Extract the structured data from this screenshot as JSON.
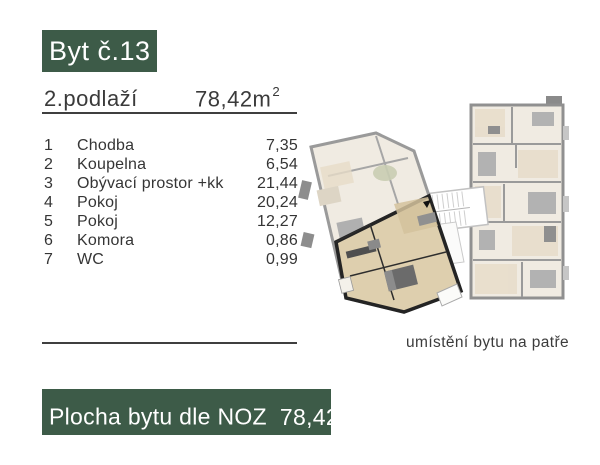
{
  "header": {
    "unit_title": "Byt č.13",
    "floor_label": "2.podlaží",
    "area_value": "78,42m",
    "area_superscript": "2"
  },
  "rooms": {
    "items": [
      {
        "no": "1",
        "name": "Chodba",
        "area": "7,35"
      },
      {
        "no": "2",
        "name": "Koupelna",
        "area": "6,54"
      },
      {
        "no": "3",
        "name": "Obývací prostor +kk",
        "area": "21,44"
      },
      {
        "no": "4",
        "name": "Pokoj",
        "area": "20,24"
      },
      {
        "no": "5",
        "name": "Pokoj",
        "area": "12,27"
      },
      {
        "no": "6",
        "name": "Komora",
        "area": "0,86"
      },
      {
        "no": "7",
        "name": "WC",
        "area": "0,99"
      }
    ]
  },
  "plan": {
    "caption": "umístění bytu na patře"
  },
  "footer": {
    "label": "Plocha bytu dle NOZ",
    "area_value": "78,42m",
    "area_superscript": "2"
  },
  "colors": {
    "accent_green": "#3d5b48",
    "text_dark": "#383838",
    "plan_faded_wall": "#9a9a9a",
    "plan_faded_floor": "#f0ebe2",
    "plan_faded_beige": "#e7dcc8",
    "plan_highlight_wall": "#242424",
    "plan_highlight_floor": "#decfae"
  }
}
